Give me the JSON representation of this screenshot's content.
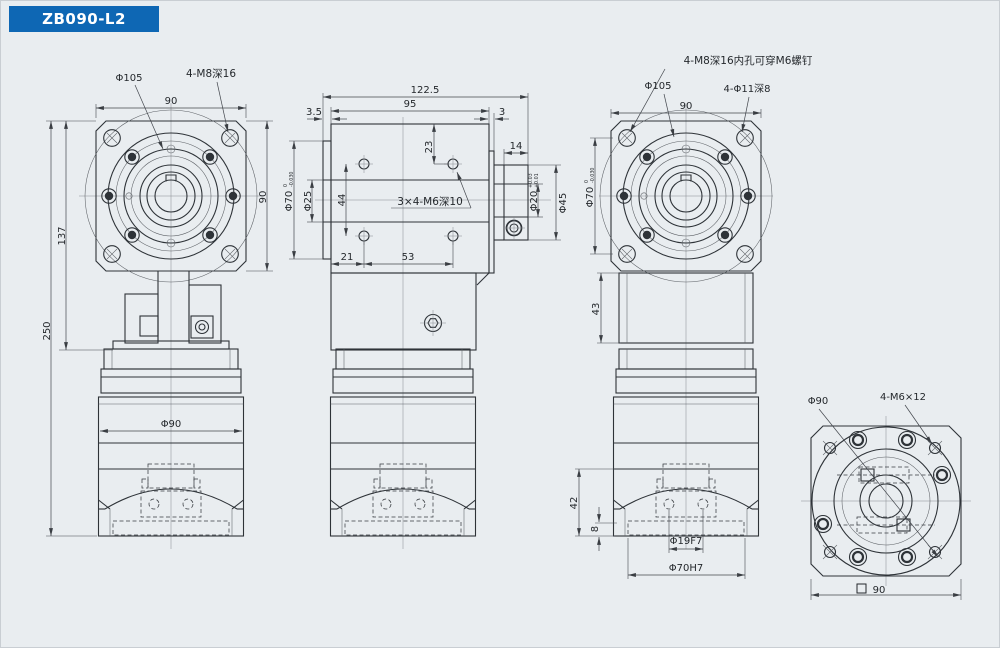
{
  "title": "ZB090-L2",
  "colors": {
    "accent": "#0e67b4",
    "background": "#e9edf0",
    "line": "#2e3338"
  },
  "drawing": {
    "front": {
      "bolt_circle": "Φ105",
      "corner_tap": "4-M8深16",
      "width_top": "90",
      "height_flange": "90",
      "h_to_plate": "137",
      "h_total": "250",
      "motor_dia": "Φ90"
    },
    "side": {
      "len_total": "122.5",
      "len_housing": "95",
      "plate_thk": "3.5",
      "cover_thk": "3",
      "hole_from_top": "23",
      "boss_len": "14",
      "pilot_dia": "Φ70",
      "pilot_tol_hi": "0",
      "pilot_tol_lo": "-0.030",
      "bore_dia": "Φ25",
      "holes_span_v": "44",
      "side_taps": "3×4-M6深10",
      "hollow_bore": "Φ20",
      "hollow_tol_hi": "+0.03",
      "hollow_tol_lo": "+0.01",
      "collar_dia": "Φ45",
      "hole_off": "21",
      "holes_span_h": "53"
    },
    "rear": {
      "corner_note": "4-M8深16内孔可穿M6螺钉",
      "bolt_circle": "Φ105",
      "cbore": "4-Φ11深8",
      "width_top": "90",
      "pilot_dia": "Φ70",
      "pilot_tol_hi": "0",
      "pilot_tol_lo": "-0.030",
      "neck_h": "43",
      "motor_flange_h": "42",
      "plate_thk": "8",
      "shaft_hole": "Φ19F7",
      "pilot_bore": "Φ70H7"
    },
    "motor_face": {
      "pilot_dia": "Φ90",
      "taps": "4-M6×12",
      "square_symbol": "□",
      "square_size": "90"
    }
  }
}
